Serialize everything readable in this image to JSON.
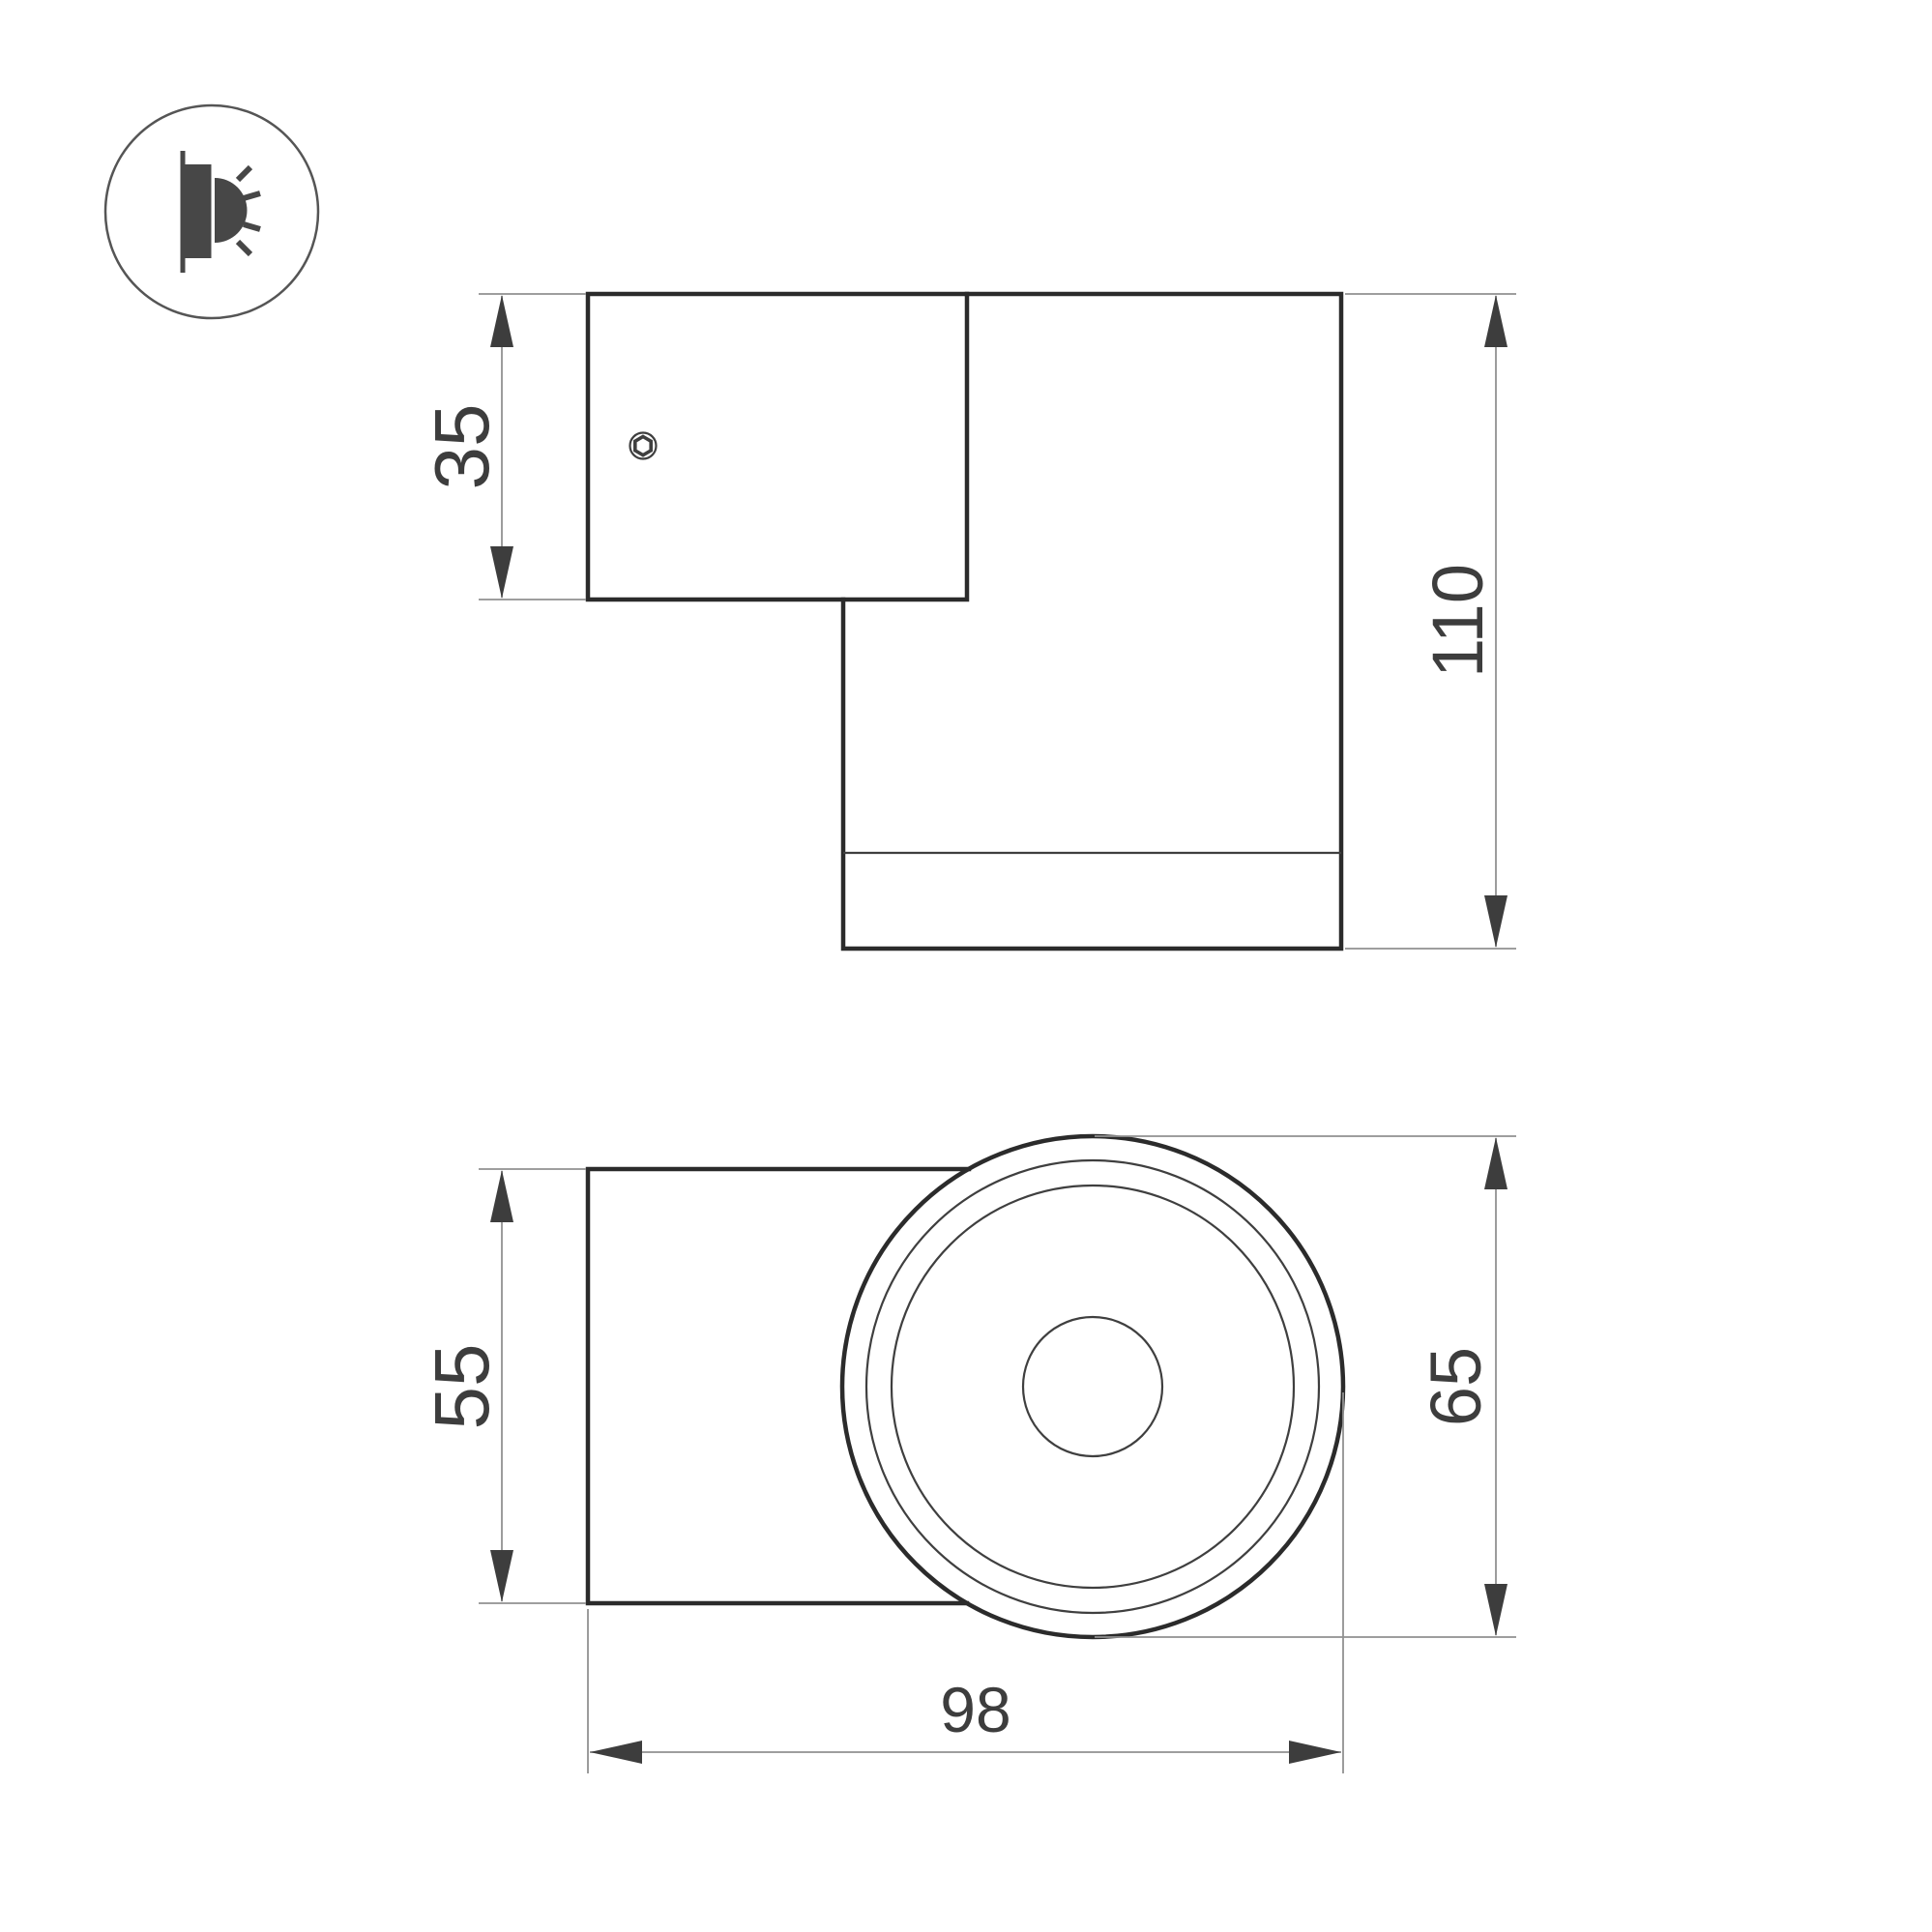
{
  "colors": {
    "background": "#ffffff",
    "outline": "#2b2b2b",
    "thin_line": "#3f3f3f",
    "dim_line": "#919191",
    "arrow": "#3d3d3d",
    "label": "#3d3d3d",
    "icon": "#474747",
    "icon_ring": "#555555"
  },
  "icon": {
    "name": "wall-lamp-side-glow"
  },
  "views": {
    "side": {
      "name": "side-view",
      "dims": [
        {
          "id": "plate-height",
          "label": "35"
        },
        {
          "id": "total-height",
          "label": "110"
        }
      ]
    },
    "bottom": {
      "name": "bottom-view",
      "dims": [
        {
          "id": "plate-width",
          "label": "55"
        },
        {
          "id": "body-diameter",
          "label": "65"
        },
        {
          "id": "total-depth",
          "label": "98"
        }
      ]
    }
  }
}
